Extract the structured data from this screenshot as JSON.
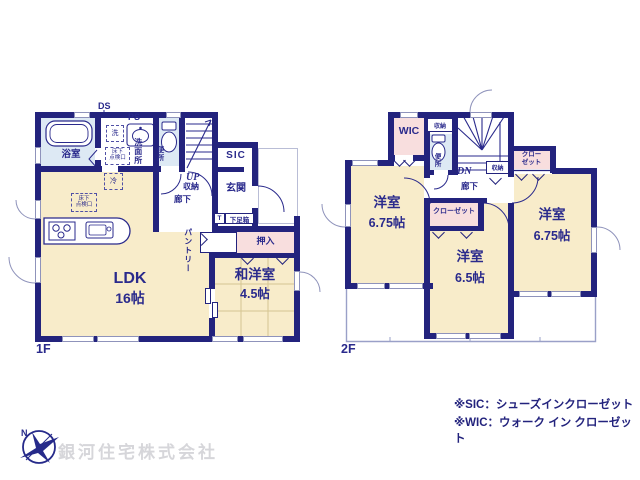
{
  "floor1": {
    "label": "1F",
    "ldk": "LDK",
    "ldk_size": "16帖",
    "washitsu": "和洋室",
    "washitsu_size": "4.5帖",
    "bath": "浴室",
    "washroom": "洗面所",
    "toilet": "便所",
    "up": "UP",
    "storage": "収納",
    "hall": "廊下",
    "sic": "SIC",
    "genkan": "玄関",
    "t": "T",
    "shoebox": "下足箱",
    "oshiire": "押入",
    "pantry": "パントリー",
    "ds": "DS",
    "ps": "PS",
    "laundry": "洗",
    "fridge": "冷",
    "hatch1": "床下",
    "hatch2": "点検口"
  },
  "floor2": {
    "label": "2F",
    "wic": "WIC",
    "storage_top": "収納",
    "storage_hall": "収納",
    "toilet": "便所",
    "dn": "DN",
    "hall": "廊下",
    "closet1": "クロー",
    "closet2": "ゼット",
    "closet_mid": "クローゼット",
    "left_room": "洋室",
    "left_size": "6.75帖",
    "mid_room": "洋室",
    "mid_size": "6.5帖",
    "right_room": "洋室",
    "right_size": "6.75帖"
  },
  "notes": {
    "sic": "※SIC：シューズインクローゼット",
    "wic": "※WIC：ウォーク イン クローゼット"
  },
  "company": {
    "name": "銀河住宅株式会社",
    "logo_n": "N"
  }
}
